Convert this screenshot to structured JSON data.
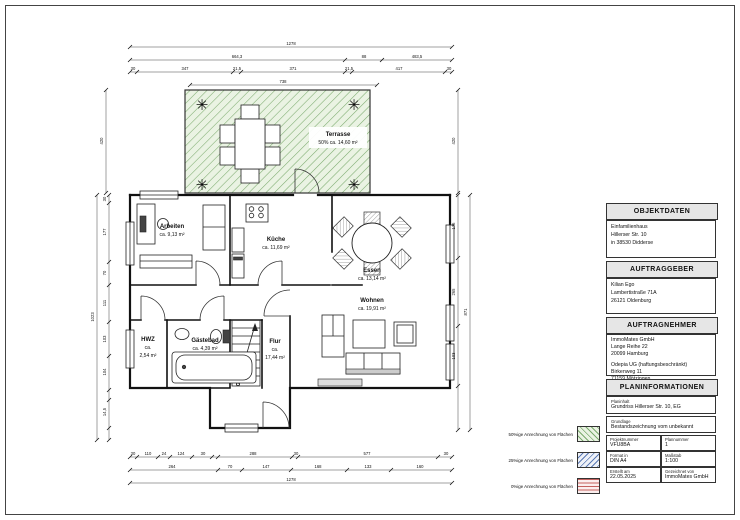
{
  "colors": {
    "terrace_fill": "#eaf3e3",
    "terrace_line": "#7cab6f",
    "legend_green": "#7cab6f",
    "legend_blue": "#5a79b5",
    "legend_red": "#c4615e"
  },
  "icons": {
    "plant": "✳"
  },
  "plan": {
    "terrace": {
      "name": "Terrasse",
      "area": "50% ca. 14,60 m²"
    },
    "rooms": [
      {
        "name": "Arbeiten",
        "area": "ca. 9,13 m²"
      },
      {
        "name": "Küche",
        "area": "ca. 11,69 m²"
      },
      {
        "name": "Essen",
        "area": "ca. 13,14 m²"
      },
      {
        "name": "Wohnen",
        "area": "ca. 19,91 m²"
      },
      {
        "name": "HWZ",
        "ca": "ca.",
        "area": "2,54 m²"
      },
      {
        "name": "Gästebad",
        "area": "ca. 4,39 m²"
      },
      {
        "name": "Flur",
        "ca": "ca.",
        "area": "17,44 m²"
      }
    ]
  },
  "dims": {
    "t1": "1278",
    "t2": "664,3",
    "t3": "88",
    "t4": "483,5",
    "t5": "30",
    "t6": "347",
    "t7": "21,5",
    "t8": "371",
    "t9": "21,5",
    "t10": "417",
    "t11": "30",
    "t12": "738",
    "b1": "30",
    "b2": "110",
    "b3": "24",
    "b4": "124",
    "b5": "30",
    "b6": "288",
    "b7": "30",
    "b8": "577",
    "b9": "30",
    "b10": "264",
    "b11": "70",
    "b12": "147",
    "b13": "168",
    "b14": "133",
    "b15": "160",
    "b16": "1278",
    "l1": "420",
    "l2": "1023",
    "l3": "30",
    "l4": "177",
    "l5": "70",
    "l6": "111",
    "l7": "103",
    "l8": "104",
    "l9": "14,5",
    "r1": "420",
    "r2": "176",
    "r3": "265",
    "r4": "103",
    "r5": "871"
  },
  "legend": {
    "item1": "50%ige Anrechnung von Flächen",
    "item2": "25%ige Anrechnung von Flächen",
    "item3": "0%ige Anrechnung von Flächen"
  },
  "panel": {
    "objektdaten": {
      "title": "OBJEKTDATEN",
      "l1": "Einfamilienhaus",
      "l2": "Hillerser Str. 10",
      "l3": "in 38530 Didderse"
    },
    "auftraggeber": {
      "title": "AUFTRAGGEBER",
      "l1": "Kilian Ego",
      "l2": "Lambertistraße 71A",
      "l3": "26121 Oldenburg"
    },
    "auftragnehmer": {
      "title": "AUFTRAGNEHMER",
      "a1": "ImmoMates GmbH",
      "a2": "Lange Reihe 22",
      "a3": "20099 Hamburg",
      "b1": "Odepia UG (haftungsbeschränkt)",
      "b2": "Birkenweg 11",
      "b3": "71159 Mötzingen"
    },
    "planinfo": {
      "title": "PLANINFORMATIONEN",
      "planinhalt_label": "Planinhalt",
      "planinhalt": "Grundriss Hillerser Str. 10, EG",
      "grundlage_label": "Grundlage",
      "grundlage": "Bestandszeichnung vom unbekannt",
      "projekt_label": "Projektnummer",
      "projekt": "VFU8BA",
      "plannr_label": "Plannummer",
      "plannr": "1",
      "format_label": "Format in",
      "format": "DIN A4",
      "massstab_label": "Maßstab",
      "massstab": "1:100",
      "erstellt_label": "Erstellt am",
      "erstellt": "22.05.2025",
      "gezeichnet_label": "Gezeichnet von",
      "gezeichnet": "ImmoMates GmbH"
    }
  }
}
